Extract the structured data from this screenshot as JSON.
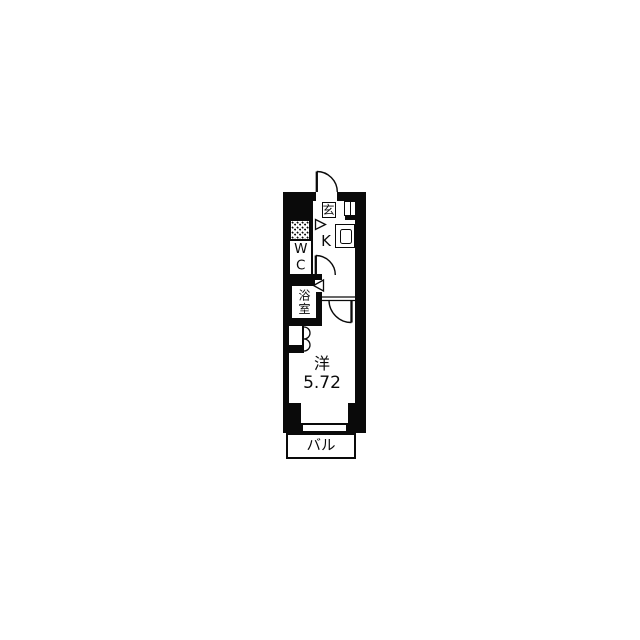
{
  "floorplan": {
    "background_color": "#ffffff",
    "wall_color": "#0a0a0a",
    "rooms": {
      "entrance_label": "玄",
      "kitchen_label": "K",
      "toilet_label": "WC",
      "bathroom_label": "浴室",
      "main_room_label": "洋",
      "main_room_area": "5.72",
      "balcony_label": "バル"
    },
    "symbols": {
      "entrance_door": "hinged-door-swing",
      "toilet_door": "hinged-door-swing",
      "room_door": "hinged-door-swing",
      "closet_door": "bifold-door",
      "bathroom_door": "folding-door-triangle",
      "laundry_door": "folding-door-triangle",
      "kitchen_sink": "sink-counter",
      "laundry_space": "dotted-floor-area",
      "meter_box": "wall-niche",
      "window": "double-line-window"
    }
  }
}
